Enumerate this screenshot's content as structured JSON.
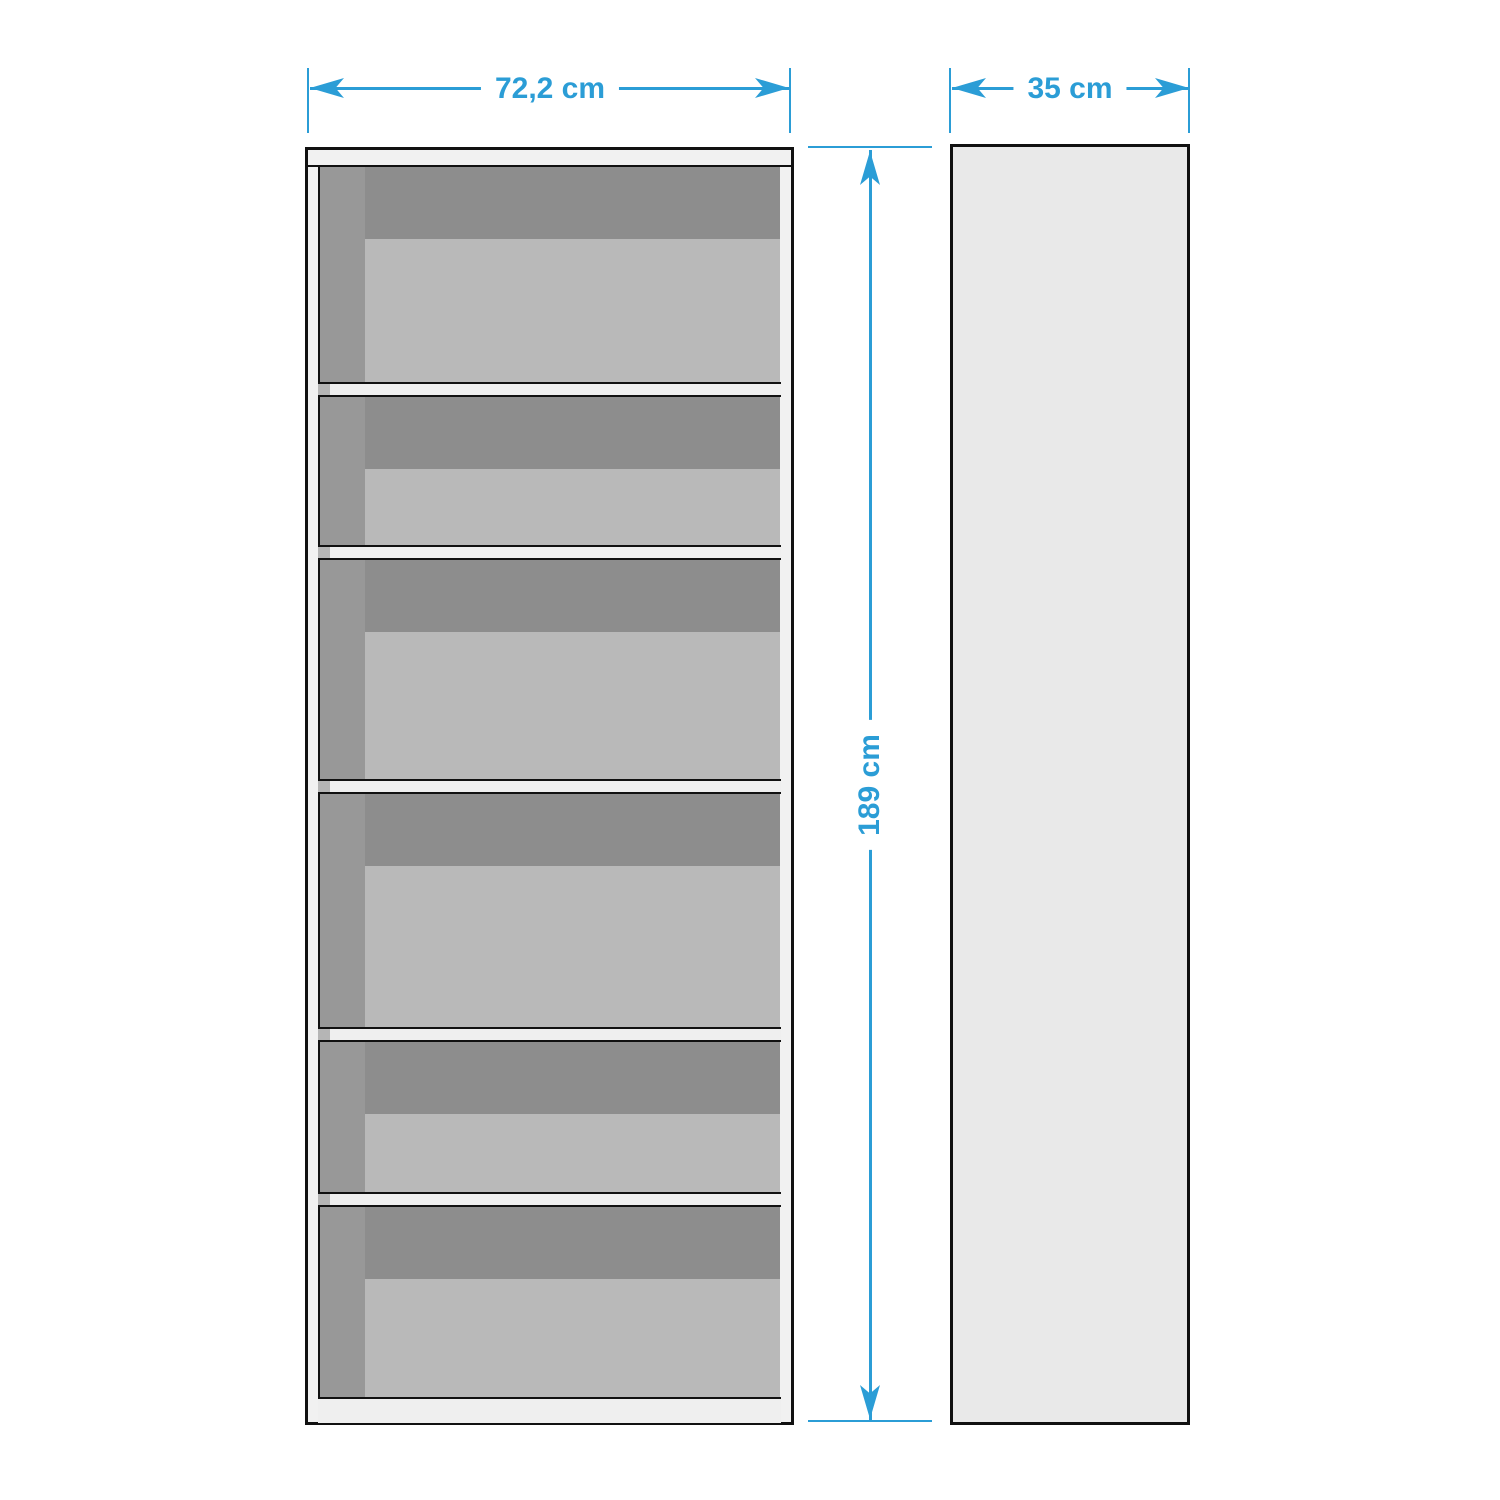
{
  "annotations": {
    "width": "72,2 cm",
    "depth": "35 cm",
    "height": "189 cm"
  },
  "front_view": {
    "shelf_compartment_count": 6,
    "shelf_divider_count": 5
  },
  "colors": {
    "dimension_accent": "#2b9dd6",
    "outline": "#111111",
    "frame_white": "#f1f1f1",
    "shelf_divider_fill": "#efefef",
    "interior_top_shadow": "#8d8d8d",
    "interior_left_shadow": "#989898",
    "back_panel": "#b9b9b9",
    "divider_shadow_square": "#b5b5b5",
    "side_view_fill": "#e9e9e9",
    "background": "#ffffff"
  }
}
